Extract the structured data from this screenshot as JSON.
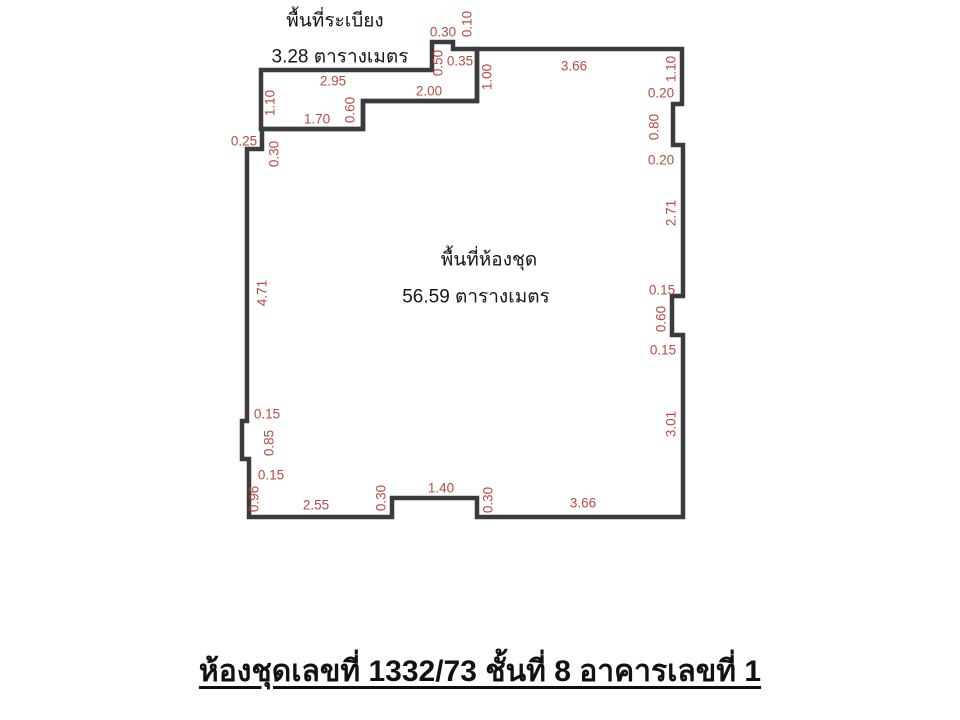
{
  "colors": {
    "wall": "#3b3b3b",
    "dimension_text": "#b94a44",
    "label_text": "#161616",
    "background": "#ffffff"
  },
  "balcony": {
    "title": "พื้นที่ระเบียง",
    "area": "3.28 ตารางเมตร",
    "dims": {
      "notch_top": "0.30",
      "notch_right": "0.10",
      "notch_left": "0.50",
      "top_gap": "0.35",
      "partition_right": "1.00",
      "top": "2.95",
      "bottom_east": "2.00",
      "west": "1.10",
      "bottom_step": "0.60",
      "bottom_west": "1.70"
    }
  },
  "unit": {
    "title": "พื้นที่ห้องชุด",
    "area": "56.59 ตารางเมตร",
    "dims": {
      "top": "3.66",
      "right_1": "1.10",
      "right_2": "0.20",
      "right_3": "0.80",
      "right_4": "0.20",
      "right_5": "2.71",
      "right_6": "0.15",
      "right_7": "0.60",
      "right_8": "0.15",
      "right_9": "3.01",
      "bottom_east": "3.66",
      "bottom_step_east": "0.30",
      "bottom_mid": "1.40",
      "bottom_step_west": "0.30",
      "bottom_west": "2.55",
      "left_1": "0.96",
      "left_2": "0.15",
      "left_3": "0.85",
      "left_4": "0.15",
      "left_5": "4.71",
      "left_6": "0.30",
      "left_7": "0.25"
    }
  },
  "footer": {
    "title": "ห้องชุดเลขที่ 1332/73 ชั้นที่ 8 อาคารเลขที่ 1"
  }
}
